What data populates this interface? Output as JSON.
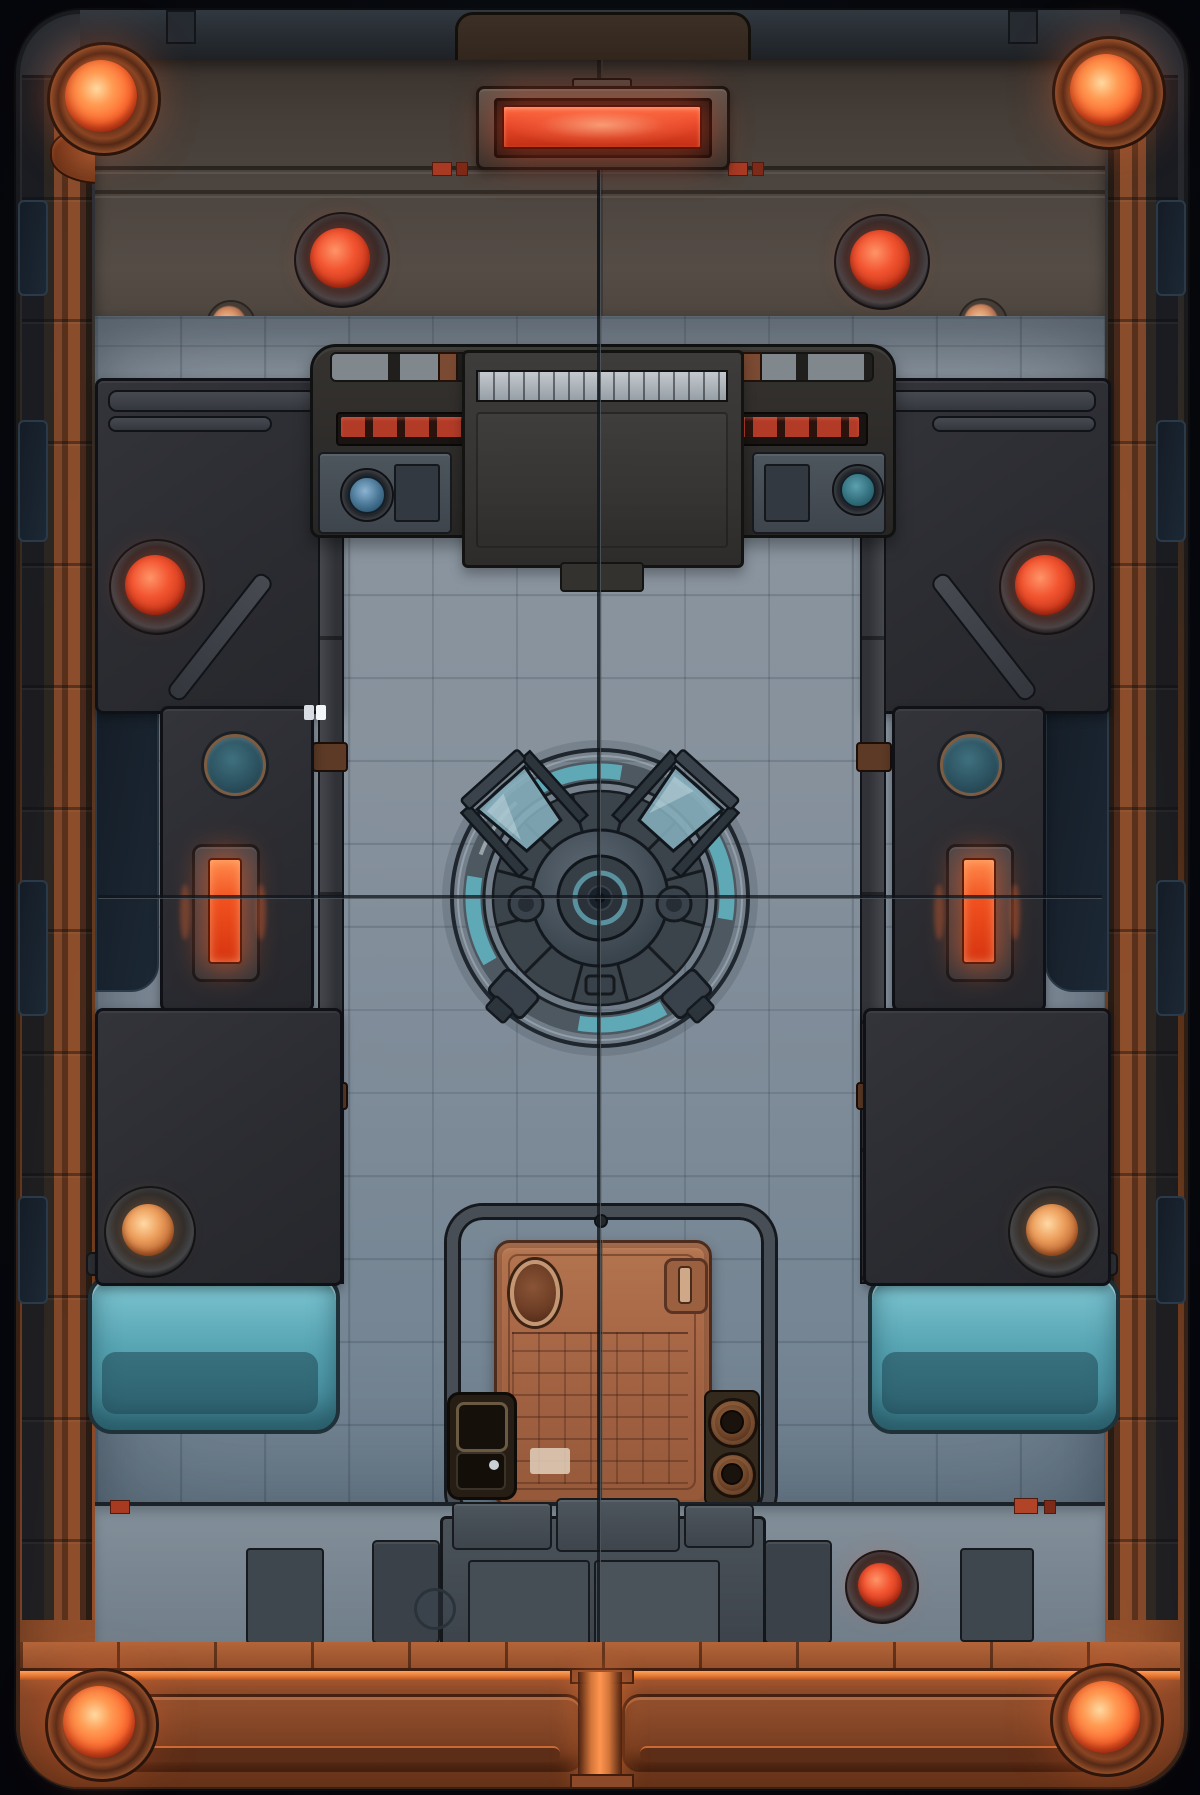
{
  "scene": {
    "title": "Sci-Fi Arena Battlemap",
    "type": "top-down battle map illustration",
    "setting": "industrial starship deck arena with central reactor hatch",
    "text_content": "none - illustration only",
    "grid": {
      "tile_px": 84,
      "style": "etched square deck tiles"
    }
  },
  "palette": {
    "bg_space": "#06080d",
    "frame_steel": "#2f363e",
    "frame_copper": "#8a4a2a",
    "copper_bright": "#b06a40",
    "lamp_glow": "#ff6a30",
    "lamp_core": "#ffd9a0",
    "dome_red": "#e04a28",
    "led_red": "#b23b28",
    "upper_wall_umber": "#4e4640",
    "wall_charcoal": "#2b2c31",
    "floor_steel": "#8c96a0",
    "floor_deep": "#6f8190",
    "teal_glow": "#63b6c6",
    "teal_recess": "#58a5b4",
    "porthole_teal": "#2c5260",
    "energy_orange": "#ff6a35",
    "hatch_copper": "#aa6a48",
    "girder_copper": "#6b3820",
    "girder_glow": "#ff9550",
    "amber_light": "#e08a4a",
    "navy_recess": "#141c26",
    "marker_white": "#f4f7f9"
  },
  "lights": {
    "corner_lamps": [
      {
        "id": "top-left",
        "cx": 101,
        "cy": 96,
        "color": "#ff6a30"
      },
      {
        "id": "top-right",
        "cx": 1106,
        "cy": 90,
        "color": "#ff6a30"
      },
      {
        "id": "bottom-left",
        "cx": 99,
        "cy": 1722,
        "color": "#ff8a40"
      },
      {
        "id": "bottom-right",
        "cx": 1104,
        "cy": 1717,
        "color": "#ff8a40"
      }
    ],
    "red_dome_lights": [
      {
        "id": "upper-wall-left",
        "cx": 340,
        "cy": 258
      },
      {
        "id": "upper-wall-right",
        "cx": 880,
        "cy": 260
      },
      {
        "id": "side-wall-left",
        "cx": 155,
        "cy": 585
      },
      {
        "id": "side-wall-right",
        "cx": 1045,
        "cy": 585
      },
      {
        "id": "bottom-wall-right",
        "cx": 880,
        "cy": 1585
      }
    ],
    "amber_dome_lights": [
      {
        "id": "lower-left",
        "cx": 148,
        "cy": 1230
      },
      {
        "id": "lower-right",
        "cx": 1052,
        "cy": 1230
      }
    ],
    "energy_bars": [
      {
        "id": "left",
        "cx": 223,
        "cy": 909,
        "color": "#ff6a35"
      },
      {
        "id": "right",
        "cx": 977,
        "cy": 909,
        "color": "#ff6a35"
      }
    ],
    "rosette_lights": [
      {
        "id": "left",
        "cx": 229,
        "cy": 323
      },
      {
        "id": "right",
        "cx": 981,
        "cy": 321
      }
    ],
    "top_light_bar": {
      "cx": 600,
      "cy": 125,
      "color": "#e8482a",
      "glow": true
    }
  },
  "objects": {
    "reactor_hatch": {
      "cx": 600,
      "cy": 898,
      "outer_radius": 148,
      "accent": "teal glass segments",
      "clamp_arms": 4
    },
    "blast_door": {
      "cx": 600,
      "cy": 1371,
      "material": "copper",
      "panels": 2,
      "hinges": 2,
      "grid_pattern": true
    },
    "console": {
      "cx": 600,
      "cy": 438,
      "led_strips": 2,
      "led_segments_per_strip": 7,
      "dials": [
        "blue",
        "teal"
      ]
    },
    "portholes": [
      {
        "id": "left",
        "cx": 232,
        "cy": 762
      },
      {
        "id": "right",
        "cx": 968,
        "cy": 762
      }
    ],
    "teal_recesses": [
      {
        "id": "bottom-left"
      },
      {
        "id": "bottom-right"
      }
    ],
    "door_side_console": {
      "buttons": 2
    },
    "white_marker": {
      "x": 310,
      "y": 712,
      "note": "small double white tile marker on left wall"
    },
    "crosshair_lines": {
      "vertical_x": 600,
      "horizontal_y": 897
    }
  }
}
